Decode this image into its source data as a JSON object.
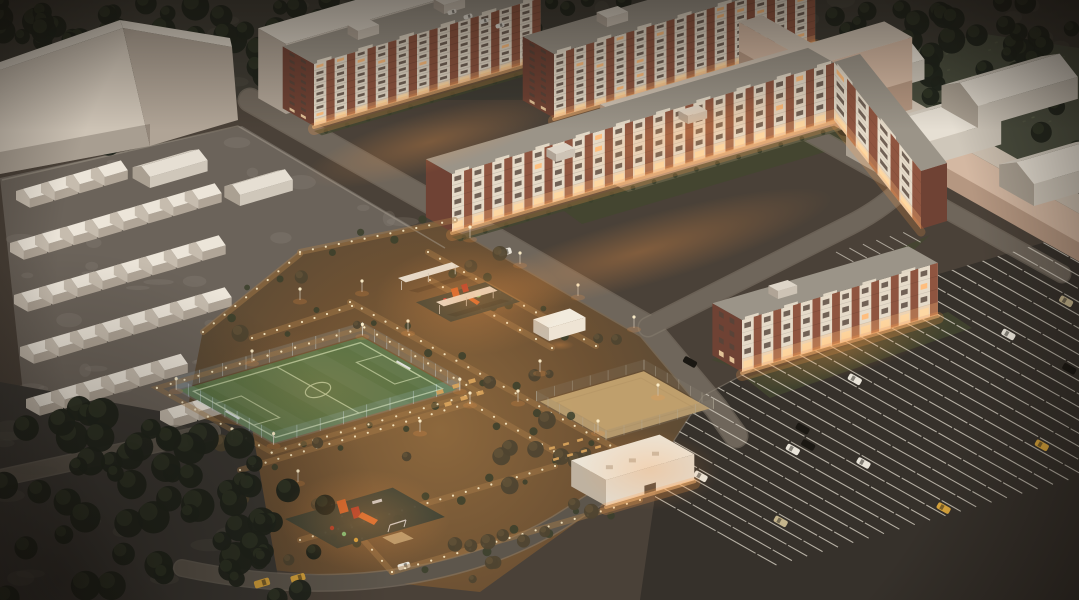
{
  "scene": {
    "title": "Residential quarter — aerial dusk rendering",
    "description": "Aerial dusk 3D architectural rendering of a residential quarter: brick apartment blocks with white balcony stacks and lit ground floors, pale untextured context buildings, rows of small gabled garages and cottages, an illuminated courtyard with playgrounds, a fenced soccer field and a sand court, tree groves, and a large angled-stall parking lot with scattered cars.",
    "time_of_day": "dusk",
    "view": "aerial-isometric",
    "palette": {
      "ground": "#4a4138",
      "ground_top": "#3e3b33",
      "yard": "#6b635a",
      "road": "#6f665b",
      "road_minor": "#5d564c",
      "road_edge": "#8a8071",
      "asphalt": "#36312b",
      "stall_line": "#d8d1c4",
      "massing_front": "#cdc3b5",
      "massing_side": "#b0a496",
      "massing_roof": "#ddd5c8",
      "massing_front_warm": "#d4b8a2",
      "brick": "#8f5540",
      "brick_dark": "#6f4234",
      "balcony": "#e6dbc9",
      "roof_flat": "#9b9488",
      "window_dark": "#54443a",
      "window_lit": "#ffbd7a",
      "window_bright": "#ffe2b0",
      "glow": "#ff9d4a",
      "lamp": "#fff1cd",
      "path_light": "#a87c49",
      "grass_dark": "#43472f",
      "grass_paver": "#4a4e3e",
      "pitch": "#5a7345",
      "pitch_line": "#bccb9f",
      "fence_blue": "#a8cde2",
      "sand": "#c2a26e",
      "sand_line": "#b59565",
      "tree_dark": "#20241b",
      "tree_lite": "#39402c",
      "tree_warm": "#4f4530",
      "shrub": "#3b3f2c",
      "car_white": "#e9e4d9",
      "car_black": "#1a1712",
      "car_yellow": "#d8a43c",
      "car_tan": "#c4b48c",
      "play_pad": "#3d4236",
      "play_orange": "#d4622a",
      "play_red": "#b53a28",
      "play_green": "#7fc97f",
      "bench": "#d8a35c",
      "vignette": "#0d0906"
    },
    "buildings": [
      {
        "id": "context-slab-northwest",
        "type": "context-massing",
        "style": "untextured pale block"
      },
      {
        "id": "context-slab-north",
        "type": "context-massing",
        "style": "untextured pale slab"
      },
      {
        "id": "context-slab-center",
        "type": "context-massing",
        "style": "large pale wall behind courtyard block"
      },
      {
        "id": "context-wall-northeast",
        "type": "context-massing",
        "style": "long low slab along northeast road"
      },
      {
        "id": "warehouse-a",
        "type": "warehouse",
        "roof": "gabled"
      },
      {
        "id": "warehouse-b",
        "type": "warehouse",
        "roof": "gabled"
      },
      {
        "id": "warehouse-c",
        "type": "warehouse",
        "roof": "gabled"
      },
      {
        "id": "warehouse-d",
        "type": "warehouse",
        "roof": "gabled"
      },
      {
        "id": "apartment-north-a",
        "type": "apartment",
        "floors": 9,
        "facade": "brick piers with white balcony stacks",
        "ground_floor_lit": true
      },
      {
        "id": "apartment-north-b",
        "type": "apartment",
        "floors": 9,
        "facade": "brick piers with white balcony stacks",
        "ground_floor_lit": true
      },
      {
        "id": "apartment-u-center",
        "type": "apartment",
        "floors": 5,
        "shape": "long block with southeast wing",
        "facade": "brick piers with white balcony stacks",
        "ground_floor_lit": true
      },
      {
        "id": "apartment-east",
        "type": "apartment",
        "floors": 4,
        "facade": "brick gable end, white balcony facade",
        "ground_floor_lit": true
      },
      {
        "id": "garage-cottage-rows",
        "type": "garages-and-cottages",
        "count": 37,
        "sheds": 2
      },
      {
        "id": "utility-building",
        "type": "service building",
        "roof": "flat with vents"
      },
      {
        "id": "courtyard-pavilion",
        "type": "small canopy pavilion"
      }
    ],
    "amenities": [
      {
        "id": "soccer-field",
        "surface": "green turf",
        "markings": "white lines, center circle, goal boxes",
        "fence": "light chain-link with posts"
      },
      {
        "id": "sand-court",
        "surface": "sand",
        "fence": "low gray fence"
      },
      {
        "id": "playground-north",
        "equipment_colors": [
          "orange",
          "red",
          "green"
        ]
      },
      {
        "id": "playground-south",
        "equipment_colors": [
          "orange",
          "red",
          "green",
          "yellow"
        ]
      },
      {
        "id": "canopy-pergolas",
        "count": 2
      },
      {
        "id": "picnic-tables",
        "count": 6
      },
      {
        "id": "benches",
        "count": 7
      },
      {
        "id": "lamp-lined-walkways",
        "style": "dotted in-ground lights"
      }
    ],
    "landscape": [
      {
        "id": "grove-southwest",
        "density": "dense dark conifers on mottled ground"
      },
      {
        "id": "tree-line-north",
        "density": "dark trees behind buildings"
      },
      {
        "id": "woods-northeast",
        "density": "dense trees around warehouses"
      },
      {
        "id": "grass-paver-northeast",
        "style": "grid-paver grass"
      }
    ],
    "parking": {
      "stalls": "angled double rows",
      "approx_cars": 40,
      "car_colors": [
        "white",
        "black",
        "yellow",
        "tan"
      ],
      "areas": [
        "main southeast lot",
        "small stalls by east wing",
        "small stalls south"
      ]
    },
    "lighting": {
      "courtyard": "warm amber floodlighting",
      "ground_floors": "bright warm lit",
      "approx_path_dots": 160
    }
  }
}
